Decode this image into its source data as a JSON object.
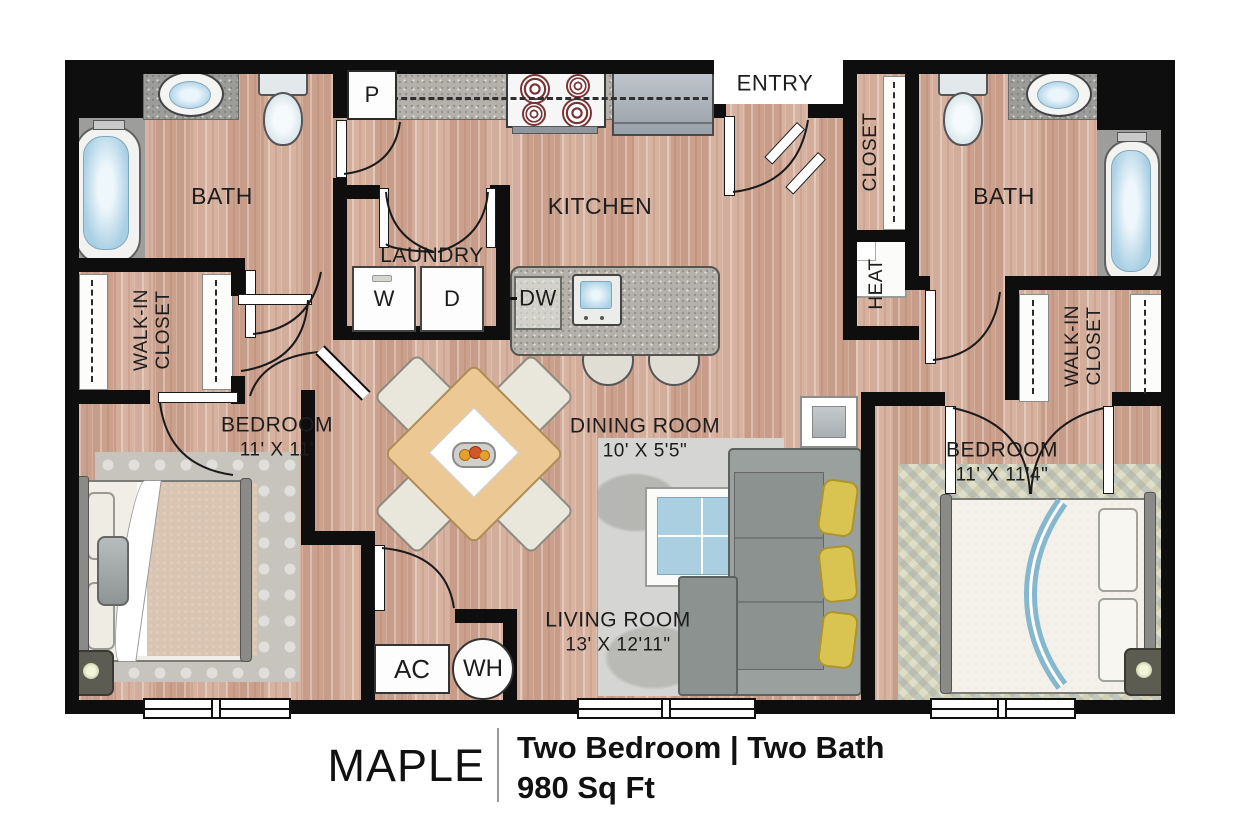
{
  "title": {
    "name": "MAPLE",
    "spec": "Two Bedroom | Two Bath",
    "area": "980 Sq Ft"
  },
  "rooms": {
    "bath_left": "BATH",
    "bath_right": "BATH",
    "kitchen": "KITCHEN",
    "laundry": "LAUNDRY",
    "entry": "ENTRY",
    "entry_closet": "CLOSET",
    "heat": "HEAT",
    "walkin_left_line1": "WALK-IN",
    "walkin_left_line2": "CLOSET",
    "walkin_right_line1": "WALK-IN",
    "walkin_right_line2": "CLOSET",
    "bedroom_left": {
      "label": "BEDROOM",
      "dims": "11' X 11'"
    },
    "bedroom_right": {
      "label": "BEDROOM",
      "dims": "11' X 11'4\""
    },
    "dining": {
      "label": "DINING ROOM",
      "dims": "10' X 5'5\""
    },
    "living": {
      "label": "LIVING ROOM",
      "dims": "13' X 12'11\""
    }
  },
  "appliances": {
    "pantry": "P",
    "washer": "W",
    "dryer": "D",
    "dishwasher": "DW",
    "ac": "AC",
    "water_heater": "WH"
  },
  "colors": {
    "wall": "#0e0e0e",
    "floor_wood": "#d2ab98",
    "counter_gray": "#b3b1a9",
    "accent_pillow": "#d9c452",
    "fixture_blue": "#a9cfe4"
  }
}
